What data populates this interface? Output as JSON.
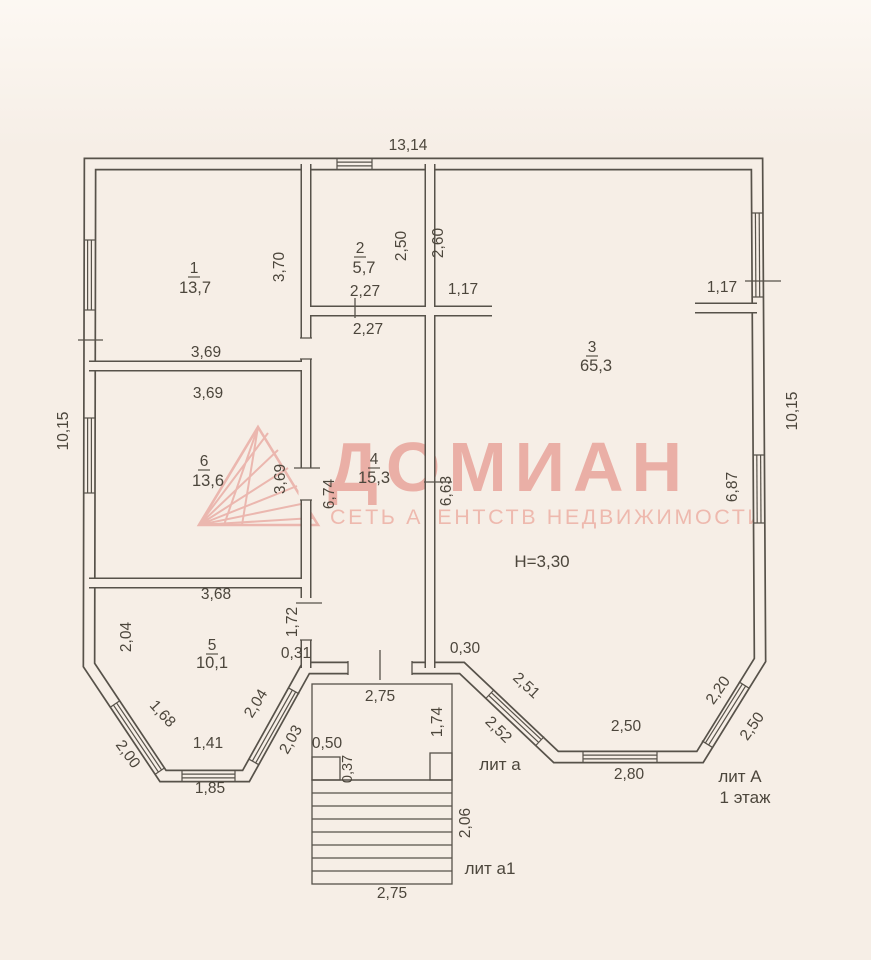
{
  "watermark": {
    "brand": "ДОМИАН",
    "tagline": "СЕТЬ АГЕНТСТВ НЕДВИЖИМОСТИ",
    "color": "#e69b91"
  },
  "plan": {
    "rooms": [
      {
        "number": "1",
        "area": "13,7"
      },
      {
        "number": "2",
        "area": "5,7"
      },
      {
        "number": "3",
        "area": "65,3"
      },
      {
        "number": "4",
        "area": "15,3"
      },
      {
        "number": "5",
        "area": "10,1"
      },
      {
        "number": "6",
        "area": "13,6"
      }
    ],
    "notes": {
      "ceiling_height": "H=3,30",
      "lit_a": "лит а",
      "lit_a1": "лит а1",
      "lit_A": "лит А",
      "floor": "1 этаж"
    },
    "dims": {
      "top_width": "13,14",
      "left_height": "10,15",
      "right_height": "10,15",
      "r1_width": "3,69",
      "r1_height": "3,70",
      "r2_height": "2,50",
      "r2_width": "2,27",
      "hall_width": "2,27",
      "r3_wall_left": "2,60",
      "r3_stub_left": "1,17",
      "r3_stub_right": "1,17",
      "r3_wall_right": "6,87",
      "r6_width": "3,69",
      "r6_height": "3,69",
      "hall_left": "6,74",
      "hall_right": "6,63",
      "r5_width": "3,68",
      "r5_left": "2,04",
      "r5_right": "1,72",
      "off_left": "0,31",
      "off_right": "0,30",
      "bay_l_win1": "1,68",
      "bay_l_win1_out": "2,00",
      "bay_l_bottom": "1,41",
      "bay_l_bottom_out": "1,85",
      "bay_l_win2": "2,04",
      "bay_l_win2_out": "2,03",
      "porch_width": "2,75",
      "porch_step_w": "0,50",
      "porch_step_d": "0,37",
      "porch_side": "1,74",
      "stairs_depth": "2,06",
      "stairs_width": "2,75",
      "bay_r_win1_out": "2,51",
      "bay_r_win1": "2,52",
      "bay_r_bottom": "2,50",
      "bay_r_bottom_out": "2,80",
      "bay_r_win2": "2,20",
      "bay_r_win2_out": "2,50"
    }
  }
}
